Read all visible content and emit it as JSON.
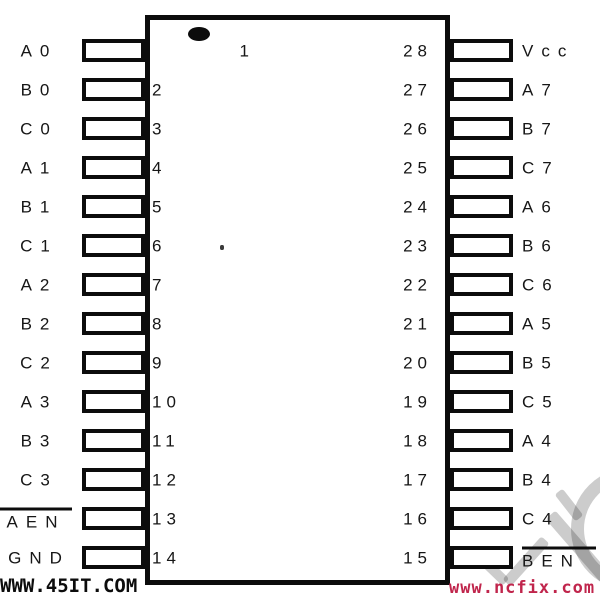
{
  "diagram": {
    "type": "28-pin DIP IC pinout",
    "pin1_indicator": "filled-oval",
    "colors": {
      "line": "#0c0c0c",
      "background": "#ffffff",
      "ncfix_red": "#c0254c",
      "logo_gray": "#cccccc"
    }
  },
  "pins": {
    "left": [
      {
        "number": "1",
        "label": "A0"
      },
      {
        "number": "2",
        "label": "B0"
      },
      {
        "number": "3",
        "label": "C0"
      },
      {
        "number": "4",
        "label": "A1"
      },
      {
        "number": "5",
        "label": "B1"
      },
      {
        "number": "6",
        "label": "C1"
      },
      {
        "number": "7",
        "label": "A2"
      },
      {
        "number": "8",
        "label": "B2"
      },
      {
        "number": "9",
        "label": "C2"
      },
      {
        "number": "10",
        "label": "A3"
      },
      {
        "number": "11",
        "label": "B3"
      },
      {
        "number": "12",
        "label": "C3"
      },
      {
        "number": "13",
        "label": "AEN",
        "overline": true
      },
      {
        "number": "14",
        "label": "GND"
      }
    ],
    "right": [
      {
        "number": "28",
        "label": "Vcc"
      },
      {
        "number": "27",
        "label": "A7"
      },
      {
        "number": "26",
        "label": "B7"
      },
      {
        "number": "25",
        "label": "C7"
      },
      {
        "number": "24",
        "label": "A6"
      },
      {
        "number": "23",
        "label": "B6"
      },
      {
        "number": "22",
        "label": "C6"
      },
      {
        "number": "21",
        "label": "A5"
      },
      {
        "number": "20",
        "label": "B5"
      },
      {
        "number": "19",
        "label": "C5"
      },
      {
        "number": "18",
        "label": "A4"
      },
      {
        "number": "17",
        "label": "B4"
      },
      {
        "number": "16",
        "label": "C4"
      },
      {
        "number": "15",
        "label": "BEN",
        "overline": true
      }
    ]
  },
  "watermarks": {
    "bottom_left": "WWW.45IT.COM",
    "bottom_right": "www.ncfix.com"
  }
}
